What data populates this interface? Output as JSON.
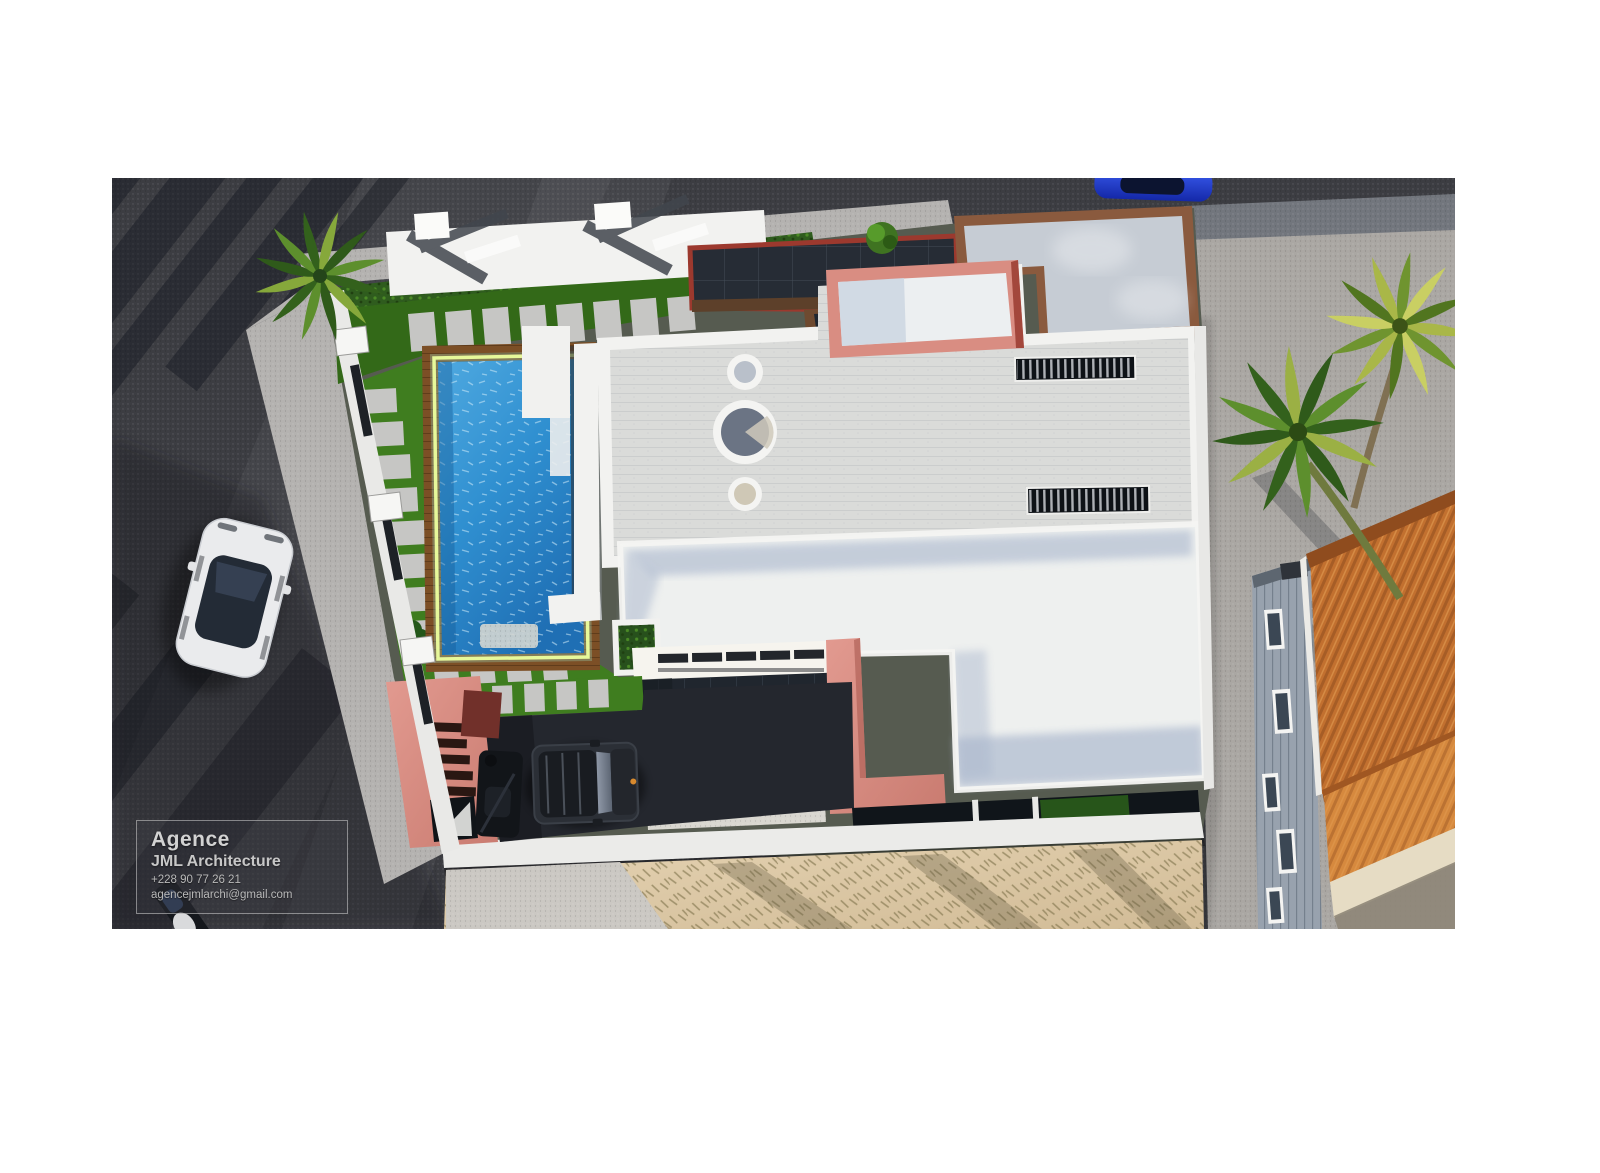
{
  "image": {
    "type": "architectural-aerial-3d-render",
    "description": "Top-down aerial 3D rendering of a modern villa compound with flat white roofs, circular skylights, swimming pool with wood deck, lawn with stepping stones, hedge, pergola wall, pink garage block, dark driveway with SUV, sandy front strip, surrounding asphalt road with white and blue cars, side street pavement, palm trees and a neighboring orange tile-roof house"
  },
  "watermark": {
    "agency_name": "Agence",
    "agency_line": "JML Architecture",
    "phone": "+228 90 77 26 21",
    "email": "agencejmlarchi@gmail.com"
  },
  "palette": {
    "asphalt": "#3c3d42",
    "sidewalk": "#b4b2b0",
    "pavement": "#aaa7a3",
    "wall_band": "#72767d",
    "grass": "#3f7d1f",
    "hedge": "#2f5c1e",
    "stone": "#c6c6c4",
    "deck_wood": "#7c4f26",
    "pool_water": "#2f8fd0",
    "pool_glow": "#ecff9e",
    "roof_light": "#dadbd9",
    "roof_white": "#f2f2f0",
    "roof_shadow": "#a9b6cc",
    "parapet_salmon": "#d98d82",
    "parapet_red": "#9c392e",
    "parapet_copper": "#8a5a3e",
    "dark_tile": "#262c35",
    "patio_tile": "#20262e",
    "pebble": "#d9d7d0",
    "feature_green": "#1d5038",
    "pink": "#d8887f",
    "sand": "#d9c5a4",
    "apron": "#cbc8c3",
    "orange_roof": "#c2702f",
    "orange_roof_light": "#d6893e",
    "neighbor_wall": "#98a2ae",
    "suv": "#2b2f36",
    "driveway": "#24272e",
    "car_white": "#eaebed",
    "car_blue": "#2749d6",
    "palm_green": "#5d8f2d",
    "palm_dark": "#33611c"
  }
}
